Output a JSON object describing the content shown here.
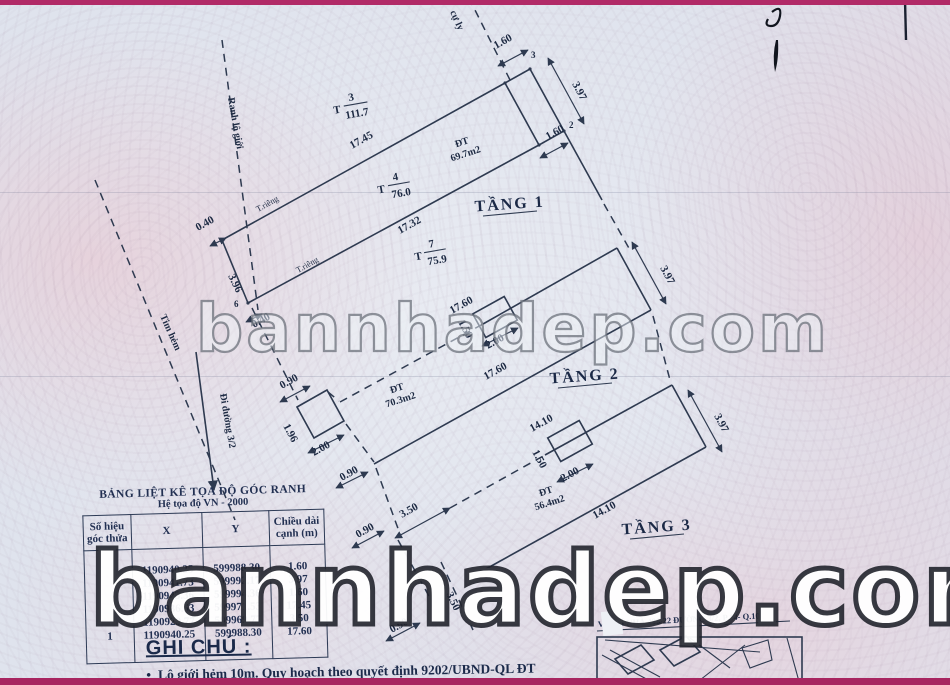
{
  "watermarks": {
    "middle": "bannhadep.com",
    "bottom": "bannhadep.com"
  },
  "plan": {
    "floor1": {
      "title": "TẦNG 1",
      "area_label": "ĐT",
      "area": "69.7m2",
      "dim_17_45": "17.45",
      "dim_17_32": "17.32",
      "dim_3_96": "3.96",
      "dim_1_60_top": "1.60",
      "dim_1_60_bottom": "1.60",
      "dim_3_97": "3.97",
      "dim_0_40_a": "0.40",
      "dim_0_40_b": "0.40",
      "pt_2": "2",
      "pt_3": "3",
      "pt_6": "6",
      "hatch_label": "54a",
      "lot_above": {
        "p": "T",
        "n": "3",
        "a": "111.7"
      },
      "lot_self": {
        "p": "T",
        "n": "4",
        "a": "76.0"
      },
      "lot_below": {
        "p": "T",
        "n": "7",
        "a": "75.9"
      },
      "wall_top": "T.riêng",
      "wall_bottom": "T.riêng"
    },
    "floor2": {
      "title": "TẦNG 2",
      "area_label": "ĐT",
      "area": "70.3m2",
      "dim_17_60_top": "17.60",
      "dim_17_60_bottom": "17.60",
      "dim_0_90_a": "0.90",
      "dim_0_90_b": "0.90",
      "dim_1_96": "1.96",
      "dim_2_00_a": "2.00",
      "dim_2_00_b": "2.00",
      "dim_1_50": "1.50",
      "dim_3_97": "3.97"
    },
    "floor3": {
      "title": "TẦNG 3",
      "area_label": "ĐT",
      "area": "56.4m2",
      "dim_14_10_top": "14.10",
      "dim_14_10_bottom": "14.10",
      "dim_3_50_a": "3.50",
      "dim_3_50_b": "3.50",
      "dim_0_90_a": "0.90",
      "dim_0_90_b": "0.90",
      "dim_1_50": "1.50",
      "dim_2_00": "2.00",
      "dim_3_97": "3.97"
    },
    "annotations": {
      "boundary": "Ranh lộ giới",
      "alley_axis": "Tim hẻm",
      "to_street": "Đi đường 3/2",
      "top_label": "cự ly"
    }
  },
  "table": {
    "title": "BẢNG LIỆT KÊ TỌA ĐỘ GÓC RANH",
    "subtitle": "Hệ tọa độ VN - 2000",
    "headers": {
      "id": "Số hiệu góc thửa",
      "x": "X",
      "y": "Y",
      "len": "Chiều dài cạnh (m)"
    },
    "col_id": "\n\n\n\n\n1",
    "col_x": "1190940.25\n1190941.73\n1190943.36\n1190936.53\n1190929.77\n1190940.25",
    "col_y": "599988.30\n599992.17\n599994.36\n599971.53\n599969.77\n599988.30",
    "col_len": "1.60\n3.97\n1.60\n17.45\n3.50\n17.60"
  },
  "notes": {
    "title": "GHI CHÚ :",
    "marker": "•",
    "bullet": "Lộ giới hẻm 10m. Quy hoạch theo quyết định 9202/UBND-QL ĐT"
  },
  "inset": {
    "title": "VỊ TRÍ NHÀ 488/22 ĐƯỜNG 3/2, P.14- Q.10"
  }
}
